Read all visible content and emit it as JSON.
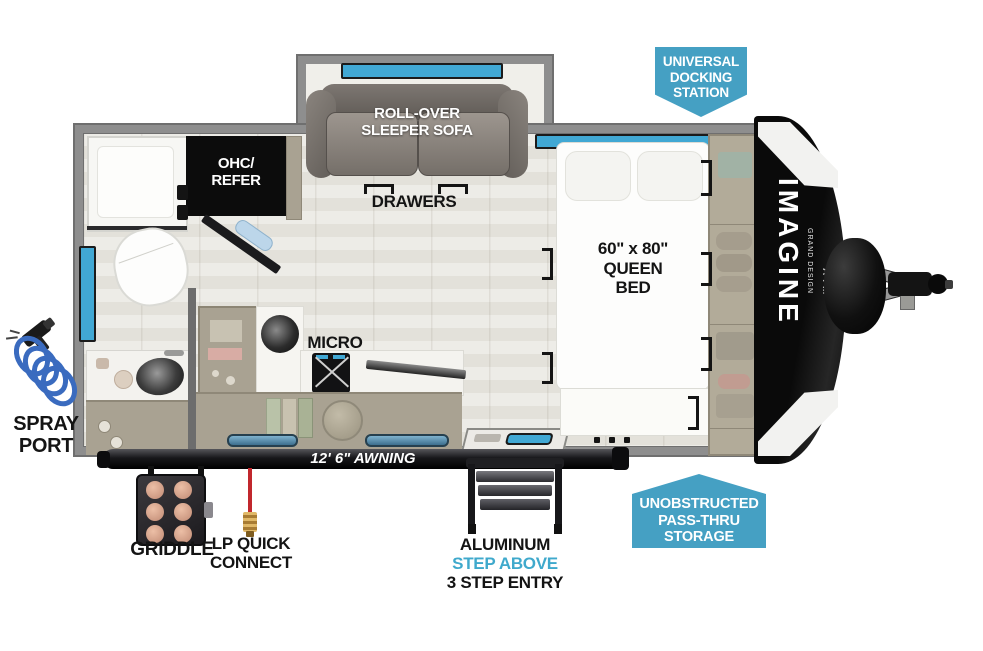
{
  "colors": {
    "badge_blue": "#45a0c3",
    "step_above_blue": "#3fa9cc",
    "window_blue": "#41a8d4",
    "lp_red": "#c1272d",
    "hose_blue": "#3a6bbf",
    "wall_gray": "#8e8e8e",
    "cabinet_tan": "#a9a292"
  },
  "interior": {
    "sofa_label": "ROLL-OVER\nSLEEPER SOFA",
    "drawers_label": "DRAWERS",
    "ohc_refer_label": "OHC/\nREFER",
    "micro_label": "MICRO",
    "bed_label": "60\" x 80\"\nQUEEN\nBED"
  },
  "callouts": {
    "docking_station": "UNIVERSAL\nDOCKING\nSTATION",
    "pass_thru_storage": "UNOBSTRUCTED\nPASS-THRU\nSTORAGE",
    "spray_port": "SPRAY\nPORT",
    "griddle": "GRIDDLE",
    "lp_quick_connect": "LP QUICK\nCONNECT",
    "awning": "12' 6\" AWNING",
    "step_material": "ALUMINUM",
    "step_feature": "STEP ABOVE",
    "step_entry": "3 STEP ENTRY"
  },
  "branding": {
    "model": "IMAGINE",
    "manufacturer": "GRAND DESIGN",
    "series": "AIM"
  }
}
